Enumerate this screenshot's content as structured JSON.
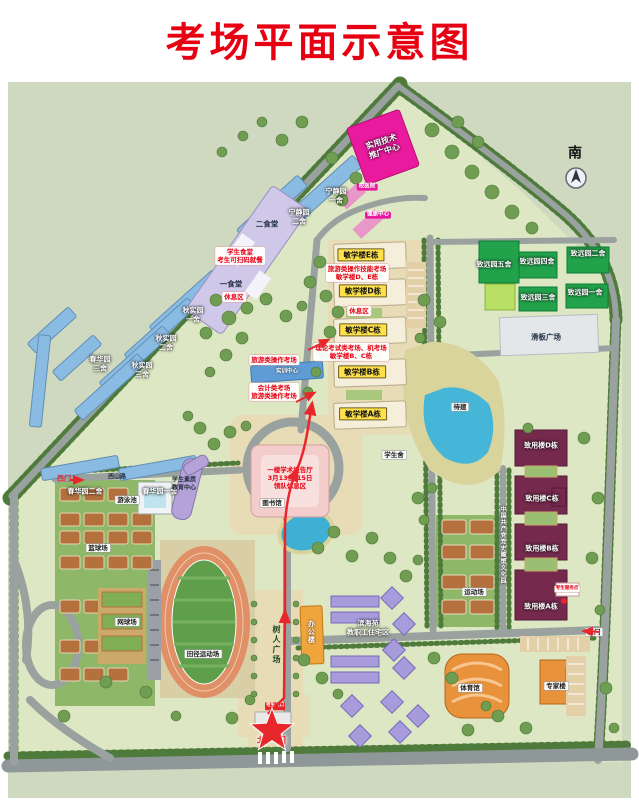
{
  "title": "考场平面示意图",
  "colors": {
    "accent": "#e60012",
    "campus": "#dde7c3",
    "road": "#9aa2a0",
    "water": "#45b6d8",
    "exam_label_bg": "#ffe24a"
  },
  "labels": [
    {
      "n": "label-canteen-notice",
      "t": "学生食堂\n考生可扫码就餐",
      "c": "redbox",
      "x": 240,
      "y": 256
    },
    {
      "n": "label-rest-area-1",
      "t": "休息区",
      "c": "redbox",
      "x": 234,
      "y": 297
    },
    {
      "n": "label-tech-center",
      "t": "实用技术\n推广中心",
      "c": "wt",
      "x": 383,
      "y": 147,
      "rot": -18,
      "fs": 8
    },
    {
      "n": "label-clinic",
      "t": "校医院",
      "c": "mag",
      "x": 367,
      "y": 187
    },
    {
      "n": "label-health-center",
      "t": "健康中心",
      "c": "mag",
      "x": 378,
      "y": 215
    },
    {
      "n": "label-dorm-ningjing-2",
      "t": "宁静园\n二舍",
      "c": "wt",
      "x": 299,
      "y": 217
    },
    {
      "n": "label-dorm-ningjing-1",
      "t": "宁静园\n一舍",
      "c": "wt",
      "x": 336,
      "y": 196
    },
    {
      "n": "label-canteen-2",
      "t": "二食堂",
      "c": "dk",
      "x": 267,
      "y": 224
    },
    {
      "n": "label-canteen-1",
      "t": "一食堂",
      "c": "dk",
      "x": 231,
      "y": 284
    },
    {
      "n": "label-building-E",
      "t": "敏学楼E栋",
      "c": "yellow",
      "x": 361,
      "y": 255
    },
    {
      "n": "label-exam-tourism-de",
      "t": "旅游类操作技能考场\n敏学楼D、E栋",
      "c": "redbox",
      "x": 357,
      "y": 273
    },
    {
      "n": "label-building-D",
      "t": "敏学楼D栋",
      "c": "yellow",
      "x": 363,
      "y": 291
    },
    {
      "n": "label-rest-area-2",
      "t": "休息区",
      "c": "redbox",
      "x": 359,
      "y": 311
    },
    {
      "n": "label-building-C",
      "t": "敏学楼C栋",
      "c": "yellow",
      "x": 363,
      "y": 330
    },
    {
      "n": "label-exam-theory-bc",
      "t": "理论考试类考场、机考场\n敏学楼B、C栋",
      "c": "redbox",
      "x": 351,
      "y": 352
    },
    {
      "n": "label-building-B",
      "t": "敏学楼B栋",
      "c": "yellow",
      "x": 362,
      "y": 372
    },
    {
      "n": "label-building-A",
      "t": "敏学楼A栋",
      "c": "yellow",
      "x": 363,
      "y": 414
    },
    {
      "n": "label-exam-tourism",
      "t": "旅游类操作考场",
      "c": "redbox",
      "x": 274,
      "y": 360
    },
    {
      "n": "label-training-center",
      "t": "实训中心",
      "c": "wtsm",
      "x": 287,
      "y": 372
    },
    {
      "n": "label-exam-accounting",
      "t": "会计类考场\n旅游类操作考场",
      "c": "redbox",
      "x": 274,
      "y": 392
    },
    {
      "n": "label-dorm-qiushi-1",
      "t": "秋实园\n一舍",
      "c": "wt",
      "x": 193,
      "y": 315
    },
    {
      "n": "label-dorm-qiushi-2",
      "t": "秋实园\n二舍",
      "c": "wt",
      "x": 166,
      "y": 343
    },
    {
      "n": "label-dorm-qiushi-3",
      "t": "秋实园\n三舍",
      "c": "wt",
      "x": 142,
      "y": 370
    },
    {
      "n": "label-dorm-chunhua-3",
      "t": "春华园\n三舍",
      "c": "wt",
      "x": 100,
      "y": 364
    },
    {
      "n": "label-dorm-chunhua-2",
      "t": "春华园二舍",
      "c": "wt",
      "x": 85,
      "y": 492
    },
    {
      "n": "label-dorm-chunhua-1",
      "t": "春华园一舍",
      "c": "wt",
      "x": 160,
      "y": 492
    },
    {
      "n": "label-west-gate",
      "t": "西门",
      "c": "redtext",
      "x": 64,
      "y": 479
    },
    {
      "n": "label-road-xishan",
      "t": "西山路",
      "c": "dksm",
      "x": 117,
      "y": 477
    },
    {
      "n": "label-library-notice",
      "t": "一楼学术报告厅\n3月13日-15日\n领队休息区",
      "c": "rednotice",
      "x": 290,
      "y": 478
    },
    {
      "n": "label-library",
      "t": "图书馆",
      "c": "whitebox",
      "x": 272,
      "y": 503
    },
    {
      "n": "label-quality-center",
      "t": "学生素质\n教育中心",
      "c": "dksm",
      "x": 184,
      "y": 484
    },
    {
      "n": "label-pool",
      "t": "游泳池",
      "c": "whitebox",
      "x": 127,
      "y": 500
    },
    {
      "n": "label-basketball",
      "t": "篮球场",
      "c": "whitebox",
      "x": 98,
      "y": 548
    },
    {
      "n": "label-tennis",
      "t": "网球场",
      "c": "whitebox",
      "x": 127,
      "y": 622
    },
    {
      "n": "label-track",
      "t": "田径运动场",
      "c": "whitebox",
      "x": 203,
      "y": 654
    },
    {
      "n": "label-dorm-zhiyuan-5",
      "t": "致远园五舍",
      "c": "wt",
      "x": 494,
      "y": 265
    },
    {
      "n": "label-dorm-zhiyuan-4",
      "t": "致远园四舍",
      "c": "wt",
      "x": 537,
      "y": 262
    },
    {
      "n": "label-dorm-zhiyuan-2",
      "t": "致远园二舍",
      "c": "wt",
      "x": 588,
      "y": 254
    },
    {
      "n": "label-dorm-zhiyuan-3",
      "t": "致远园三舍",
      "c": "wt",
      "x": 538,
      "y": 298
    },
    {
      "n": "label-dorm-zhiyuan-1",
      "t": "致远园一舍",
      "c": "wt",
      "x": 585,
      "y": 293
    },
    {
      "n": "label-skate-plaza",
      "t": "滑板广场",
      "c": "dk",
      "x": 546,
      "y": 337
    },
    {
      "n": "label-to-be-built",
      "t": "待建",
      "c": "whitebox",
      "x": 460,
      "y": 407
    },
    {
      "n": "label-student-hall",
      "t": "学生舍",
      "c": "whitebox",
      "x": 394,
      "y": 455
    },
    {
      "n": "label-zhiyong-D",
      "t": "致用楼D栋",
      "c": "wt",
      "x": 541,
      "y": 446
    },
    {
      "n": "label-zhiyong-C",
      "t": "致用楼C栋",
      "c": "wt",
      "x": 542,
      "y": 499
    },
    {
      "n": "label-zhiyong-B",
      "t": "致用楼B栋",
      "c": "wt",
      "x": 542,
      "y": 549
    },
    {
      "n": "label-zhiyong-A",
      "t": "致用楼A栋",
      "c": "wt",
      "x": 541,
      "y": 607
    },
    {
      "n": "label-exam-service",
      "t": "考生服务点",
      "c": "tinyredbox",
      "x": 567,
      "y": 589
    },
    {
      "n": "label-culture-park",
      "t": "中国共产党党史雕塑文化园",
      "c": "vtextw",
      "x": 502,
      "y": 545
    },
    {
      "n": "label-sports-field",
      "t": "运动场",
      "c": "whitebox",
      "x": 474,
      "y": 592
    },
    {
      "n": "label-east-gate",
      "t": "东门",
      "c": "whitebox",
      "x": 594,
      "y": 632
    },
    {
      "n": "label-gym",
      "t": "体育馆",
      "c": "whitebox",
      "x": 470,
      "y": 688
    },
    {
      "n": "label-expert-building",
      "t": "专家楼",
      "c": "whitebox",
      "x": 556,
      "y": 686
    },
    {
      "n": "label-staff-housing",
      "t": "滨海苑\n教职工住宅区",
      "c": "wt",
      "x": 368,
      "y": 628
    },
    {
      "n": "label-office-building",
      "t": "办公楼",
      "c": "vtextwo",
      "x": 311,
      "y": 632
    },
    {
      "n": "label-shuren-plaza",
      "t": "树人广场",
      "c": "vtextd",
      "x": 276,
      "y": 645
    },
    {
      "n": "label-north-gate",
      "t": "北一门",
      "c": "gatetext",
      "x": 272,
      "y": 742
    },
    {
      "n": "label-gate-entry",
      "t": "考生入口",
      "c": "tinyredbadge",
      "x": 275,
      "y": 706
    },
    {
      "n": "label-compass-south",
      "t": "南",
      "c": "compass",
      "x": 575,
      "y": 154
    }
  ]
}
